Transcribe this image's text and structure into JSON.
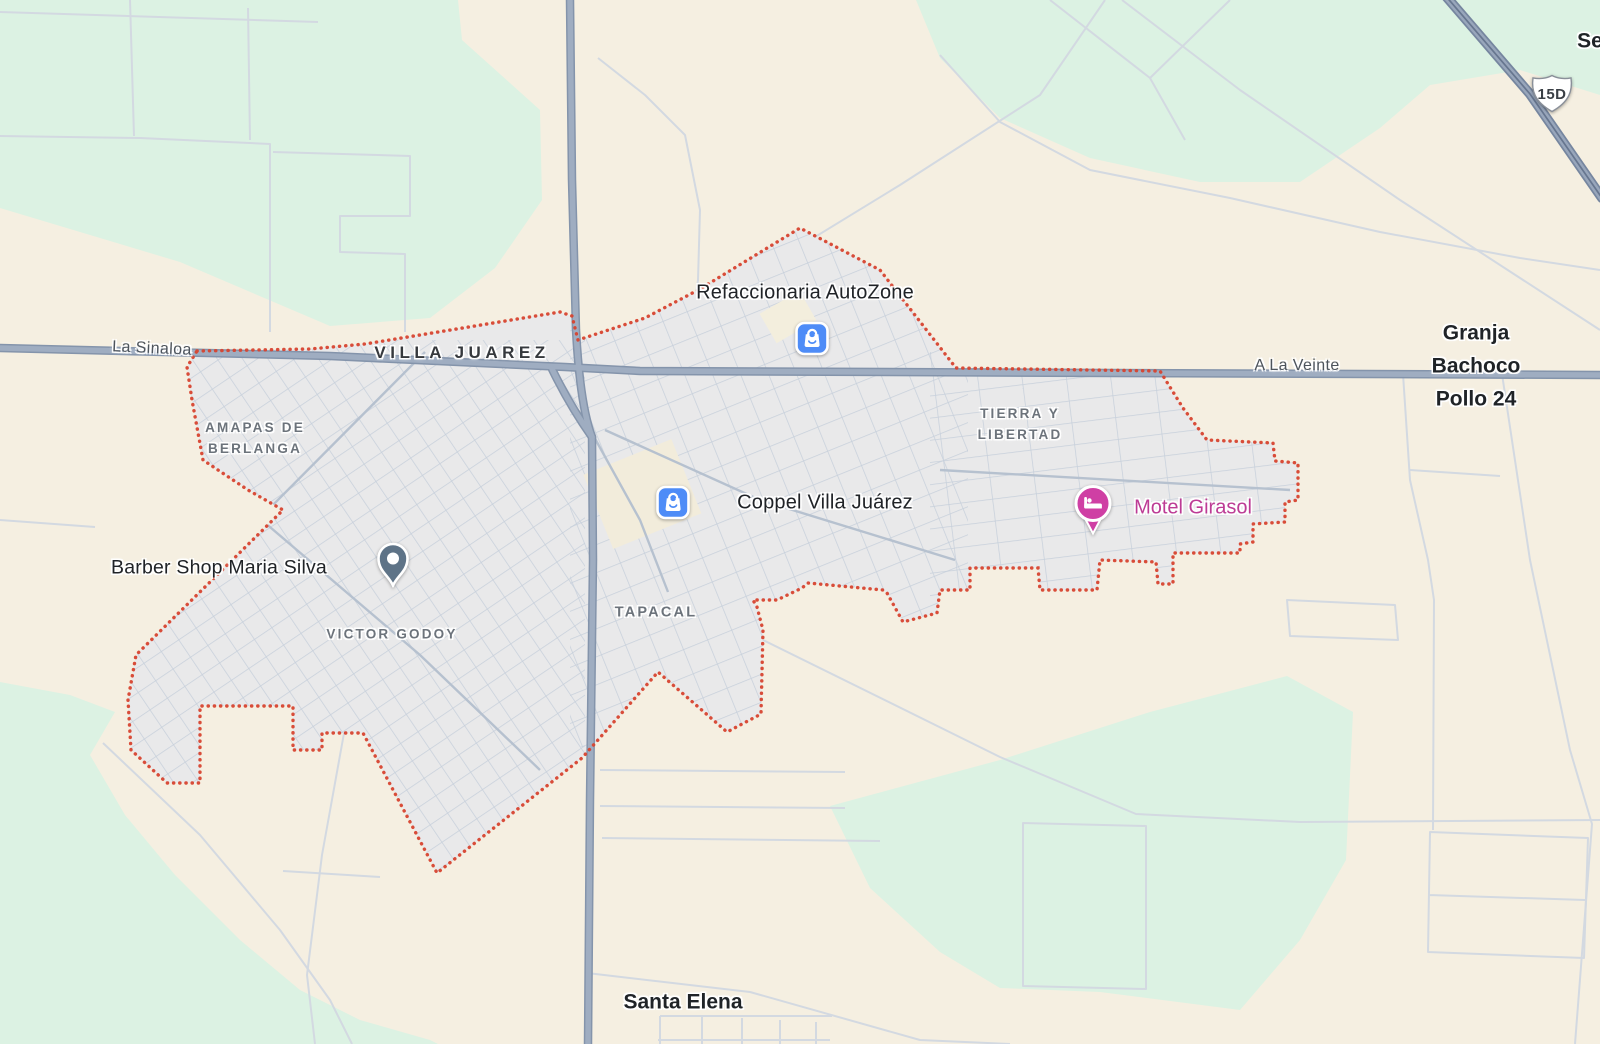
{
  "app": {
    "description": "Map viewport of Villa Juarez, Sinaloa area"
  },
  "labels": {
    "la_sinaloa": "La Sinaloa",
    "villa_juarez": "VILLA JUAREZ",
    "amapas_de_berlanga": "AMAPAS DE\nBERLANGA",
    "refaccionaria_autozone": "Refaccionaria AutoZone",
    "tierra_y_libertad": "TIERRA Y\nLIBERTAD",
    "a_la_veinte": "A La Veinte",
    "granja_bachoco": "Granja\nBachoco\nPollo 24",
    "coppel": "Coppel Villa Juárez",
    "motel_girasol": "Motel Girasol",
    "barber_shop": "Barber Shop Maria Silva",
    "victor_godoy": "VICTOR GODOY",
    "tapacal": "TAPACAL",
    "santa_elena": "Santa Elena",
    "partial_right_edge": "Se",
    "highway_shield": "15D"
  },
  "icons": [
    {
      "name": "shopping-bag-icon",
      "for": "Refaccionaria AutoZone",
      "color": "#4e8cf7"
    },
    {
      "name": "shopping-bag-icon",
      "for": "Coppel Villa Juárez",
      "color": "#4e8cf7"
    },
    {
      "name": "bed-pin-icon",
      "for": "Motel Girasol",
      "color": "#cf3fa4"
    },
    {
      "name": "location-pin-icon",
      "for": "Barber Shop Maria Silva",
      "color": "#5e7387"
    },
    {
      "name": "highway-shield-icon",
      "for": "15D",
      "color": "#ffffff"
    }
  ],
  "colors": {
    "land_beige": "#f5efe1",
    "park_green": "#dcf2e3",
    "urban_fill": "#e9e9ea",
    "minor_street": "#c7d0db",
    "major_road": "#9fadc1",
    "major_road_casing": "#8494ab",
    "boundary_red": "#d7432f",
    "poi_text": "#202327",
    "area_text": "#6c737b",
    "motel_pink": "#cf3fa4",
    "poi_blue": "#4e8cf7",
    "pin_slate": "#5e7387"
  }
}
